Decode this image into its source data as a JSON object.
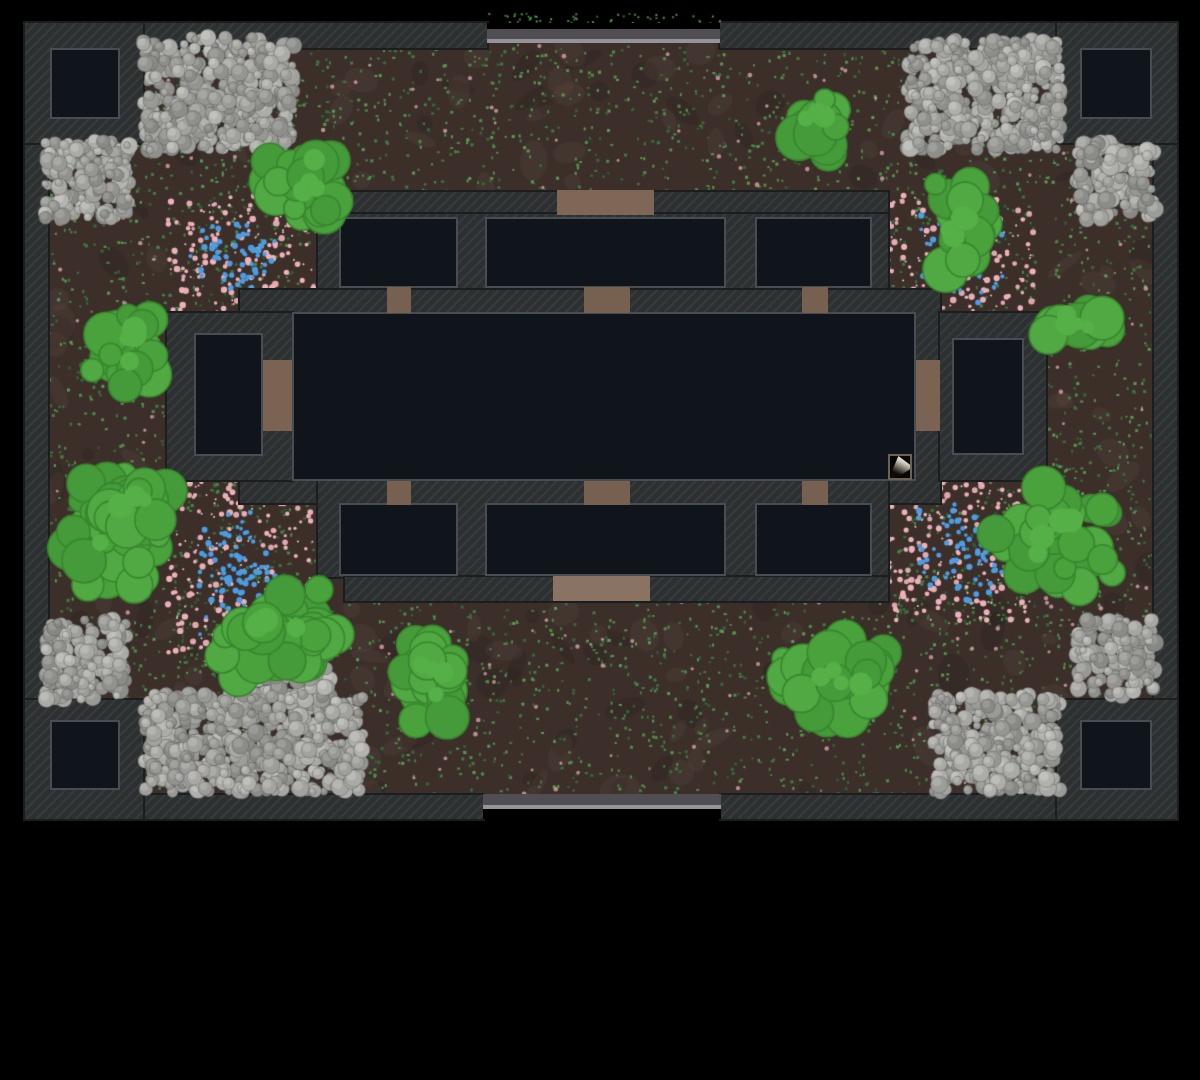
{
  "scene": {
    "kind": "top-down-game-map",
    "background": "#000000",
    "map_rect": {
      "x": 25,
      "y": 23,
      "w": 1152,
      "h": 796
    }
  },
  "palette": {
    "ground": "#3c2f2a",
    "wall": "#2d3031",
    "wall_edge": "#1b1e1f",
    "room_fill": "#10151b",
    "room_border": "#474d53",
    "door_top": "#7e6757",
    "door_bottom": "#8b7364",
    "door_small": "#76604f",
    "door_tall": "#7b6353",
    "gate_bar": "#504e52",
    "gate_rail": "#949399",
    "bush_fills": [
      "#4aa23c",
      "#51a943",
      "#459a39"
    ],
    "bush_edge": "#38862e",
    "flower_pink": "#eeb1ba",
    "flower_blue": "#4b9de4",
    "speckle_greens": [
      "#4f8d4a",
      "#417c41",
      "#35693a",
      "#5c9a52"
    ],
    "speckle_pink": "#d8a3ad"
  },
  "walls": [
    {
      "name": "outer-wall-top-left",
      "x": 25,
      "y": 23,
      "w": 462,
      "h": 25
    },
    {
      "name": "outer-wall-top-right",
      "x": 720,
      "y": 23,
      "w": 457,
      "h": 25
    },
    {
      "name": "outer-wall-bottom-left",
      "x": 25,
      "y": 795,
      "w": 458,
      "h": 24
    },
    {
      "name": "outer-wall-bottom-right",
      "x": 721,
      "y": 795,
      "w": 456,
      "h": 24
    },
    {
      "name": "outer-wall-left",
      "x": 25,
      "y": 23,
      "w": 23,
      "h": 796
    },
    {
      "name": "outer-wall-right",
      "x": 1154,
      "y": 23,
      "w": 23,
      "h": 796
    },
    {
      "name": "corner-block-nw",
      "x": 25,
      "y": 23,
      "w": 118,
      "h": 120
    },
    {
      "name": "corner-block-ne",
      "x": 1057,
      "y": 23,
      "w": 120,
      "h": 120
    },
    {
      "name": "corner-block-sw",
      "x": 25,
      "y": 700,
      "w": 118,
      "h": 119
    },
    {
      "name": "corner-block-se",
      "x": 1057,
      "y": 700,
      "w": 120,
      "h": 119
    },
    {
      "name": "building-north-wall",
      "x": 345,
      "y": 192,
      "w": 543,
      "h": 24
    },
    {
      "name": "building-north-rooms-band",
      "x": 318,
      "y": 214,
      "w": 570,
      "h": 99
    },
    {
      "name": "building-hall-frame",
      "x": 240,
      "y": 290,
      "w": 700,
      "h": 213
    },
    {
      "name": "building-west-wing",
      "x": 167,
      "y": 313,
      "w": 125,
      "h": 167
    },
    {
      "name": "building-east-wing",
      "x": 940,
      "y": 313,
      "w": 106,
      "h": 167
    },
    {
      "name": "building-south-rooms-band",
      "x": 318,
      "y": 481,
      "w": 570,
      "h": 96
    },
    {
      "name": "building-south-wall",
      "x": 345,
      "y": 577,
      "w": 543,
      "h": 24
    }
  ],
  "rooms": [
    {
      "name": "room-corner-nw",
      "x": 50,
      "y": 48,
      "w": 70,
      "h": 71
    },
    {
      "name": "room-corner-ne",
      "x": 1080,
      "y": 48,
      "w": 72,
      "h": 71
    },
    {
      "name": "room-corner-sw",
      "x": 50,
      "y": 720,
      "w": 70,
      "h": 70
    },
    {
      "name": "room-corner-se",
      "x": 1080,
      "y": 720,
      "w": 72,
      "h": 70
    },
    {
      "name": "room-north-west",
      "x": 339,
      "y": 217,
      "w": 119,
      "h": 71
    },
    {
      "name": "room-north-center",
      "x": 485,
      "y": 217,
      "w": 241,
      "h": 71
    },
    {
      "name": "room-north-east",
      "x": 755,
      "y": 217,
      "w": 117,
      "h": 71
    },
    {
      "name": "room-west",
      "x": 194,
      "y": 333,
      "w": 69,
      "h": 123
    },
    {
      "name": "central-hall",
      "x": 292,
      "y": 312,
      "w": 624,
      "h": 169
    },
    {
      "name": "room-east",
      "x": 952,
      "y": 338,
      "w": 72,
      "h": 117
    },
    {
      "name": "room-south-west",
      "x": 339,
      "y": 503,
      "w": 119,
      "h": 73
    },
    {
      "name": "room-south-center",
      "x": 485,
      "y": 503,
      "w": 241,
      "h": 73
    },
    {
      "name": "room-south-east",
      "x": 755,
      "y": 503,
      "w": 117,
      "h": 73
    }
  ],
  "doors": [
    {
      "name": "door-north-main",
      "x": 557,
      "y": 190,
      "w": 97,
      "h": 25,
      "tone": "top"
    },
    {
      "name": "door-nw-to-hall",
      "x": 387,
      "y": 287,
      "w": 24,
      "h": 26,
      "tone": "small"
    },
    {
      "name": "door-ncenter-to-hall",
      "x": 584,
      "y": 287,
      "w": 46,
      "h": 26,
      "tone": "small"
    },
    {
      "name": "door-ne-to-hall",
      "x": 802,
      "y": 287,
      "w": 26,
      "h": 26,
      "tone": "small"
    },
    {
      "name": "door-west-to-hall",
      "x": 263,
      "y": 360,
      "w": 29,
      "h": 71,
      "tone": "tall"
    },
    {
      "name": "door-east-to-hall",
      "x": 916,
      "y": 360,
      "w": 24,
      "h": 71,
      "tone": "tall"
    },
    {
      "name": "door-sw-to-hall",
      "x": 387,
      "y": 481,
      "w": 24,
      "h": 24,
      "tone": "small"
    },
    {
      "name": "door-scenter-to-hall",
      "x": 584,
      "y": 481,
      "w": 46,
      "h": 24,
      "tone": "small"
    },
    {
      "name": "door-se-to-hall",
      "x": 802,
      "y": 481,
      "w": 26,
      "h": 24,
      "tone": "small"
    },
    {
      "name": "door-south-main",
      "x": 553,
      "y": 576,
      "w": 97,
      "h": 25,
      "tone": "bottom"
    }
  ],
  "gates": [
    {
      "name": "gate-north",
      "x": 487,
      "w": 233,
      "black": {
        "y": 23,
        "h": 6
      },
      "bar": {
        "y": 29,
        "h": 10
      },
      "rail": {
        "y": 39,
        "h": 4
      }
    },
    {
      "name": "gate-south",
      "x": 483,
      "w": 238,
      "bar": {
        "y": 794,
        "h": 11
      },
      "rail": {
        "y": 805,
        "h": 4
      },
      "black": {
        "y": 809,
        "h": 10
      }
    }
  ],
  "features": {
    "speckle_regions": [
      [
        48,
        44,
        1105,
        148
      ],
      [
        48,
        192,
        119,
        603
      ],
      [
        1046,
        192,
        107,
        603
      ],
      [
        167,
        601,
        879,
        194
      ]
    ],
    "gate_speckles": [
      487,
      12,
      233,
      12
    ],
    "flowers": [
      [
        168,
        192,
        147,
        128
      ],
      [
        888,
        192,
        147,
        138
      ],
      [
        168,
        480,
        147,
        185
      ],
      [
        888,
        480,
        147,
        142
      ]
    ],
    "rocks": [
      [
        143,
        37,
        152,
        113
      ],
      [
        45,
        140,
        85,
        80
      ],
      [
        907,
        40,
        153,
        110
      ],
      [
        1077,
        142,
        78,
        78
      ],
      [
        45,
        620,
        82,
        80
      ],
      [
        143,
        693,
        220,
        99
      ],
      [
        240,
        655,
        90,
        45
      ],
      [
        933,
        695,
        127,
        97
      ],
      [
        1077,
        620,
        78,
        76
      ]
    ],
    "bushes": [
      [
        255,
        137,
        90,
        88
      ],
      [
        785,
        90,
        60,
        65
      ],
      [
        925,
        183,
        67,
        92
      ],
      [
        1045,
        303,
        68,
        45
      ],
      [
        85,
        303,
        73,
        94
      ],
      [
        58,
        462,
        127,
        128
      ],
      [
        207,
        588,
        146,
        95
      ],
      [
        395,
        638,
        75,
        90
      ],
      [
        783,
        632,
        115,
        96
      ],
      [
        995,
        488,
        130,
        104
      ]
    ]
  },
  "item_marker": {
    "x": 888,
    "y": 454,
    "w": 24,
    "h": 26
  }
}
